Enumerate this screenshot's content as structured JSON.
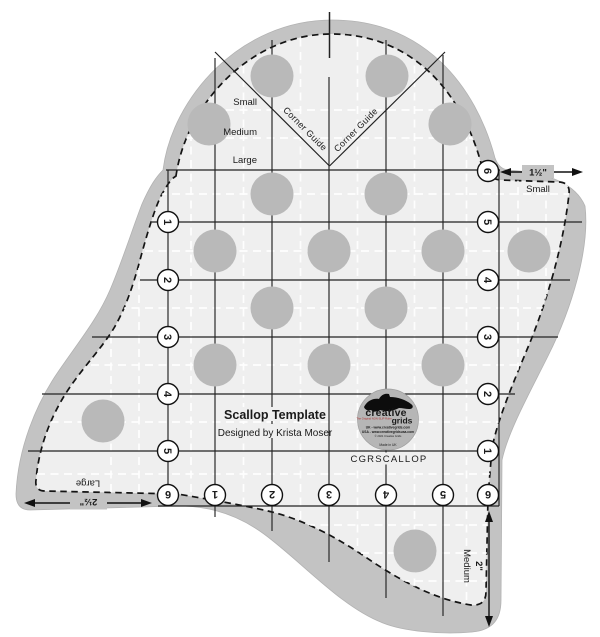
{
  "product": {
    "title": "Scallop Template",
    "designer": "Designed by Krista Moser",
    "sku": "CGRSCALLOP"
  },
  "scallop_sizes": {
    "small": "Small",
    "medium": "Medium",
    "large": "Large"
  },
  "corner_guide_label": "Corner Guide",
  "measurements": {
    "small_width": "1½\"",
    "small_label": "Small",
    "large_width": "2½\"",
    "large_label": "Large",
    "medium_width": "2\"",
    "medium_label": "Medium"
  },
  "ruler_numbers": {
    "left": [
      "1",
      "2",
      "3",
      "4",
      "5"
    ],
    "right": [
      "6",
      "5",
      "4",
      "3",
      "2",
      "1"
    ],
    "bottom": [
      "6",
      "1",
      "2",
      "3",
      "4",
      "5",
      "6"
    ]
  },
  "logo": {
    "brand_line1": "creative",
    "brand_line2": "grids",
    "tagline": "The Original NON-SLIP Ruler",
    "uk_site": "UK - www.creativegrids.com",
    "usa_site": "USA - www.creativegridsusa.com",
    "copyright": "© 2021 Creative Grids",
    "origin": "Made in UK"
  },
  "colors": {
    "plate": "#efefef",
    "band": "#c3c3c3",
    "dot": "#b9b9b9",
    "line": "#222222",
    "logo_bg": "#b6b6b6",
    "accent_red": "#b03030"
  }
}
